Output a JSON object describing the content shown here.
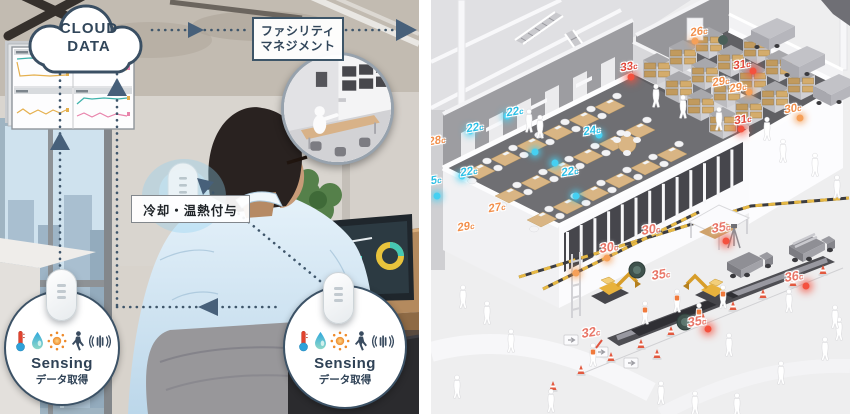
{
  "left_panel": {
    "cloud": {
      "line1": "CLOUD",
      "line2": "DATA"
    },
    "facility": {
      "line1": "ファシリティ",
      "line2": "マネジメント"
    },
    "cooling_label": "冷却・温熱付与",
    "sensing_left": {
      "title": "Sensing",
      "subtitle": "データ取得"
    },
    "sensing_right": {
      "title": "Sensing",
      "subtitle": "データ取得"
    },
    "sensor_icon_names": [
      "thermometer-icon",
      "droplet-icon",
      "sun-icon",
      "person-icon",
      "vibration-icon"
    ]
  },
  "right_panel": {
    "temp_unit": "c",
    "temps": [
      {
        "x": 84,
        "y": 112,
        "v": "22",
        "kind": "cool"
      },
      {
        "x": 44,
        "y": 128,
        "v": "22",
        "kind": "cool"
      },
      {
        "x": 161,
        "y": 131,
        "v": "24",
        "kind": "cool"
      },
      {
        "x": 38,
        "y": 172,
        "v": "22",
        "kind": "cool"
      },
      {
        "x": 2,
        "y": 181,
        "v": "25",
        "kind": "cool"
      },
      {
        "x": 139,
        "y": 172,
        "v": "22",
        "kind": "cool"
      },
      {
        "x": 6,
        "y": 141,
        "v": "28",
        "kind": "warm"
      },
      {
        "x": 66,
        "y": 208,
        "v": "27",
        "kind": "warm"
      },
      {
        "x": 35,
        "y": 227,
        "v": "29",
        "kind": "warm"
      },
      {
        "x": 268,
        "y": 32,
        "v": "26",
        "kind": "warm"
      },
      {
        "x": 198,
        "y": 67,
        "v": "33",
        "kind": "hot"
      },
      {
        "x": 311,
        "y": 65,
        "v": "31",
        "kind": "hot"
      },
      {
        "x": 290,
        "y": 82,
        "v": "29",
        "kind": "warm"
      },
      {
        "x": 307,
        "y": 88,
        "v": "29",
        "kind": "warm"
      },
      {
        "x": 362,
        "y": 109,
        "v": "30",
        "kind": "warm"
      },
      {
        "x": 312,
        "y": 120,
        "v": "31",
        "kind": "hot"
      },
      {
        "x": 220,
        "y": 229,
        "v": "30",
        "kind": "site"
      },
      {
        "x": 290,
        "y": 227,
        "v": "35",
        "kind": "site"
      },
      {
        "x": 178,
        "y": 247,
        "v": "30",
        "kind": "site"
      },
      {
        "x": 230,
        "y": 274,
        "v": "35",
        "kind": "site"
      },
      {
        "x": 363,
        "y": 276,
        "v": "36",
        "kind": "site"
      },
      {
        "x": 266,
        "y": 321,
        "v": "35",
        "kind": "site"
      },
      {
        "x": 160,
        "y": 332,
        "v": "32",
        "kind": "site"
      }
    ],
    "dots": [
      {
        "x": 76,
        "y": 116,
        "k": "cool"
      },
      {
        "x": 39,
        "y": 131,
        "k": "cool"
      },
      {
        "x": 168,
        "y": 135,
        "k": "cool"
      },
      {
        "x": 31,
        "y": 176,
        "k": "cool"
      },
      {
        "x": 124,
        "y": 163,
        "k": "cool"
      },
      {
        "x": 145,
        "y": 196,
        "k": "cool"
      },
      {
        "x": 104,
        "y": 152,
        "k": "cool"
      },
      {
        "x": 6,
        "y": 196,
        "k": "cool"
      },
      {
        "x": 264,
        "y": 41,
        "k": "warm"
      },
      {
        "x": 318,
        "y": 92,
        "k": "warm"
      },
      {
        "x": 369,
        "y": 118,
        "k": "warm"
      },
      {
        "x": 176,
        "y": 258,
        "k": "warm"
      },
      {
        "x": 145,
        "y": 273,
        "k": "warm"
      },
      {
        "x": 200,
        "y": 77,
        "k": "hot"
      },
      {
        "x": 322,
        "y": 71,
        "k": "hot"
      },
      {
        "x": 310,
        "y": 129,
        "k": "hot"
      },
      {
        "x": 295,
        "y": 241,
        "k": "hot"
      },
      {
        "x": 375,
        "y": 286,
        "k": "hot"
      },
      {
        "x": 277,
        "y": 329,
        "k": "hot"
      }
    ],
    "accent_colors": {
      "cool": "#2bbfe6",
      "warm": "#f28f4b",
      "hot": "#e2493b",
      "site": "#e87466"
    }
  }
}
